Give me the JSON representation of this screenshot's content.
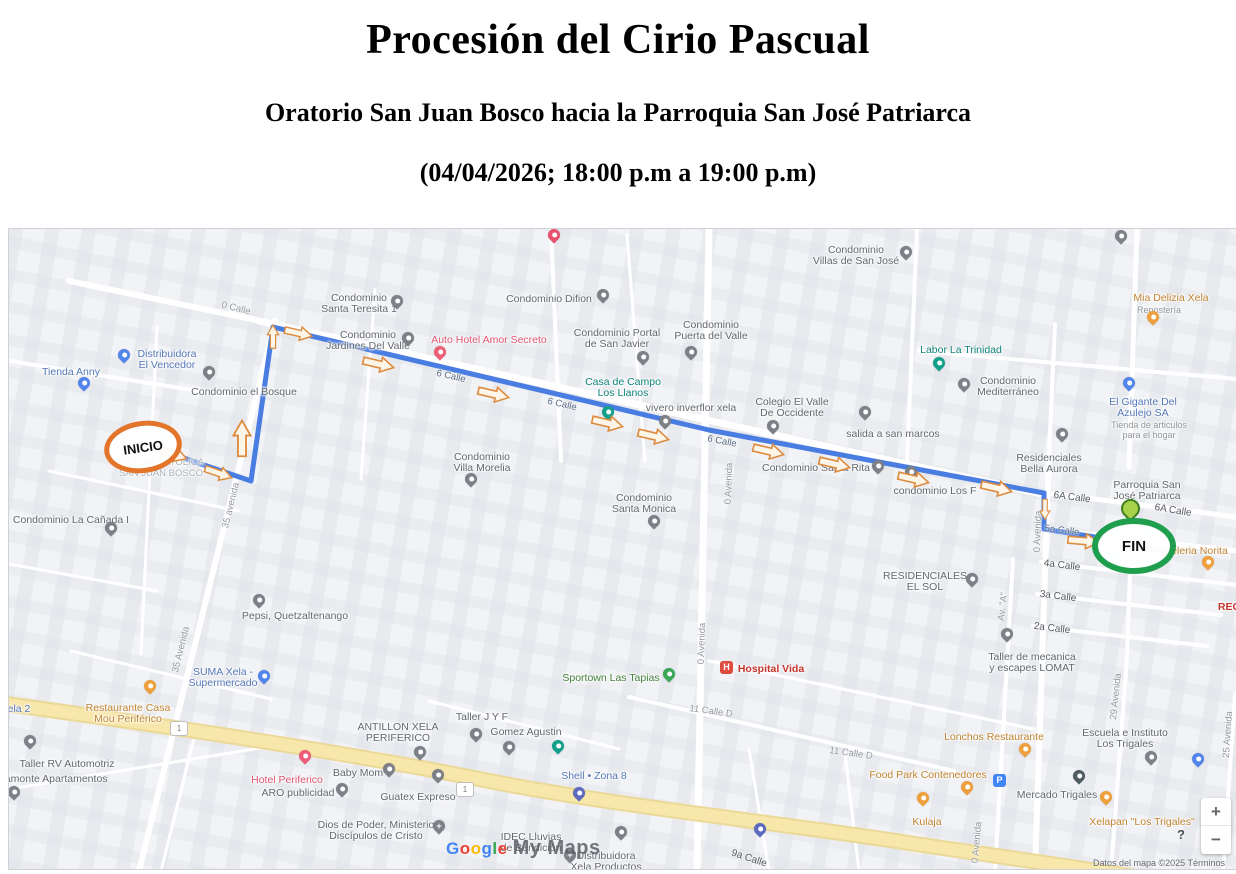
{
  "header": {
    "title": "Procesión del Cirio Pascual",
    "subtitle": "Oratorio San Juan Bosco hacia la Parroquia San José Patriarca",
    "schedule": "(04/04/2026; 18:00 p.m a 19:00 p.m)"
  },
  "map": {
    "attribution": "Datos del mapa ©2025      Términos",
    "watermark": {
      "brand": "Google",
      "product": "My Maps",
      "brand_colors": [
        "#4285F4",
        "#EA4335",
        "#FBBC05",
        "#4285F4",
        "#34A853",
        "#EA4335"
      ]
    },
    "controls": {
      "zoom_in": "+",
      "zoom_out": "−",
      "help": "?"
    },
    "route": {
      "start_label": "INICIO",
      "end_label": "FIN",
      "color": "#4a7de2",
      "start_ring_color": "#e2752a",
      "end_ring_color": "#1f9e4d",
      "points": [
        [
          157,
          223
        ],
        [
          242,
          252
        ],
        [
          264,
          98
        ],
        [
          700,
          201
        ],
        [
          1035,
          264
        ],
        [
          1035,
          300
        ],
        [
          1092,
          309
        ]
      ],
      "arrows": [
        {
          "x": 164,
          "y": 225,
          "r": 19,
          "s": 0.9
        },
        {
          "x": 209,
          "y": 244,
          "r": 19,
          "s": 0.9
        },
        {
          "x": 233,
          "y": 210,
          "r": -90,
          "s": 1.15
        },
        {
          "x": 264,
          "y": 108,
          "r": -90,
          "s": 0.75
        },
        {
          "x": 289,
          "y": 104,
          "r": 13,
          "s": 0.9
        },
        {
          "x": 369,
          "y": 135,
          "r": 13,
          "s": 1
        },
        {
          "x": 484,
          "y": 165,
          "r": 13,
          "s": 1
        },
        {
          "x": 598,
          "y": 194,
          "r": 13,
          "s": 1
        },
        {
          "x": 644,
          "y": 207,
          "r": 13,
          "s": 1
        },
        {
          "x": 759,
          "y": 222,
          "r": 13,
          "s": 1
        },
        {
          "x": 825,
          "y": 235,
          "r": 13,
          "s": 1
        },
        {
          "x": 904,
          "y": 250,
          "r": 13,
          "s": 1
        },
        {
          "x": 987,
          "y": 259,
          "r": 13,
          "s": 1
        },
        {
          "x": 1036,
          "y": 280,
          "r": 90,
          "s": 0.65
        },
        {
          "x": 1074,
          "y": 312,
          "r": 5,
          "s": 1
        }
      ]
    },
    "shields": {
      "label": "1",
      "positions": [
        {
          "x": 169,
          "y": 499
        },
        {
          "x": 455,
          "y": 560
        }
      ]
    },
    "street_labels": [
      {
        "text": "0 Calle",
        "x": 227,
        "y": 74,
        "rot": 14
      },
      {
        "text": "35 avenida",
        "x": 222,
        "y": 271,
        "rot": -76
      },
      {
        "text": "6 Calle",
        "x": 442,
        "y": 142,
        "rot": 13,
        "cls": "route"
      },
      {
        "text": "6 Calle",
        "x": 553,
        "y": 170,
        "rot": 13,
        "cls": "route"
      },
      {
        "text": "6 Calle",
        "x": 713,
        "y": 207,
        "rot": 11,
        "cls": "route"
      },
      {
        "text": "0 Avenida",
        "x": 720,
        "y": 249,
        "rot": -88
      },
      {
        "text": "0 Avenida",
        "x": 693,
        "y": 409,
        "rot": -88
      },
      {
        "text": "6A Calle",
        "x": 1063,
        "y": 263,
        "rot": 7,
        "cls": "dark"
      },
      {
        "text": "6A Calle",
        "x": 1164,
        "y": 276,
        "rot": 9,
        "cls": "dark"
      },
      {
        "text": "5a Calle",
        "x": 1053,
        "y": 296,
        "rot": 7,
        "cls": "route"
      },
      {
        "text": "4a Calle",
        "x": 1053,
        "y": 331,
        "rot": 7,
        "cls": "dark"
      },
      {
        "text": "3a Calle",
        "x": 1049,
        "y": 362,
        "rot": 7,
        "cls": "dark"
      },
      {
        "text": "2a Calle",
        "x": 1043,
        "y": 394,
        "rot": 7,
        "cls": "dark"
      },
      {
        "text": "0 Avenida",
        "x": 1029,
        "y": 297,
        "rot": -88
      },
      {
        "text": "0 Avenida",
        "x": 968,
        "y": 608,
        "rot": -85
      },
      {
        "text": "Av. \"A\"",
        "x": 994,
        "y": 372,
        "rot": -83
      },
      {
        "text": "29 Avenida",
        "x": 1107,
        "y": 462,
        "rot": -84
      },
      {
        "text": "25 Avenida",
        "x": 1219,
        "y": 500,
        "rot": -86
      },
      {
        "text": "11 Calle D",
        "x": 702,
        "y": 477,
        "rot": 8
      },
      {
        "text": "11 Calle D",
        "x": 842,
        "y": 519,
        "rot": 8
      },
      {
        "text": "35 Avenida",
        "x": 172,
        "y": 415,
        "rot": -76
      },
      {
        "text": "9a Calle",
        "x": 740,
        "y": 624,
        "rot": 18,
        "cls": "dark"
      }
    ],
    "pois": [
      {
        "lines": [
          "Tienda Anny"
        ],
        "cls": "blue",
        "lx": 62,
        "ly": 138,
        "pin": {
          "x": 75,
          "y": 162,
          "c": "#5185ec"
        }
      },
      {
        "lines": [
          "Distribuidora",
          "El Vencedor"
        ],
        "cls": "blue",
        "lx": 158,
        "ly": 120,
        "pin": {
          "x": 115,
          "y": 134,
          "c": "#5185ec"
        }
      },
      {
        "lines": [
          "SUMA Xela -",
          "Supermercado"
        ],
        "cls": "blue",
        "lx": 214,
        "ly": 438,
        "pin": {
          "x": 255,
          "y": 455,
          "c": "#5185ec"
        }
      },
      {
        "lines": [
          "Shell • Zona 8"
        ],
        "cls": "blue",
        "lx": 585,
        "ly": 542,
        "pin": {
          "x": 570,
          "y": 572,
          "c": "#5c6bc0"
        }
      },
      {
        "lines": [
          "El Gigante Del",
          "Azulejo SA"
        ],
        "cls": "blue",
        "lx": 1134,
        "ly": 168,
        "pin": {
          "x": 1120,
          "y": 162,
          "c": "#5185ec"
        }
      },
      {
        "lines": [
          "Tienda de articulos",
          "para el hogar"
        ],
        "cls": "graysmall",
        "lx": 1140,
        "ly": 191
      },
      {
        "lines": [
          "Condominio el Bosque"
        ],
        "cls": "gray",
        "lx": 235,
        "ly": 158,
        "pin": {
          "x": 200,
          "y": 151,
          "c": "#7d8187"
        }
      },
      {
        "lines": [
          "Condominio La Cañada I"
        ],
        "cls": "gray",
        "lx": 62,
        "ly": 286,
        "pin": {
          "x": 102,
          "y": 307,
          "c": "#7d8187"
        }
      },
      {
        "lines": [
          "Condominio",
          "Santa Teresita 1"
        ],
        "cls": "gray",
        "lx": 350,
        "ly": 64,
        "pin": {
          "x": 388,
          "y": 80,
          "c": "#7d8187"
        }
      },
      {
        "lines": [
          "Condominio",
          "Jardines Del Valle"
        ],
        "cls": "gray",
        "lx": 359,
        "ly": 101,
        "pin": {
          "x": 399,
          "y": 117,
          "c": "#7d8187"
        }
      },
      {
        "lines": [
          "Auto Hotel Amor Secreto"
        ],
        "cls": "pink",
        "lx": 480,
        "ly": 106,
        "pin": {
          "x": 431,
          "y": 131,
          "c": "#ee5d78"
        }
      },
      {
        "lines": [
          "Condominio Difion"
        ],
        "cls": "gray",
        "lx": 540,
        "ly": 65,
        "pin": {
          "x": 594,
          "y": 74,
          "c": "#7d8187"
        }
      },
      {
        "lines": [
          "Condominio Portal",
          "de San Javier"
        ],
        "cls": "gray",
        "lx": 608,
        "ly": 99,
        "pin": {
          "x": 634,
          "y": 136,
          "c": "#7d8187"
        }
      },
      {
        "lines": [
          "Condominio",
          "Puerta del Valle"
        ],
        "cls": "gray",
        "lx": 702,
        "ly": 91,
        "pin": {
          "x": 682,
          "y": 131,
          "c": "#7d8187"
        }
      },
      {
        "lines": [
          "Condominio",
          "Villas de San José"
        ],
        "cls": "gray",
        "lx": 847,
        "ly": 16,
        "pin": {
          "x": 897,
          "y": 31,
          "c": "#7d8187"
        }
      },
      {
        "lines": [
          "Casa de Campo",
          "Los Llanos"
        ],
        "cls": "teal",
        "lx": 614,
        "ly": 148,
        "pin": {
          "x": 599,
          "y": 191,
          "c": "#13a08b"
        }
      },
      {
        "lines": [
          "vivero inverflor xela"
        ],
        "cls": "gray",
        "lx": 682,
        "ly": 174,
        "pin": {
          "x": 656,
          "y": 200,
          "c": "#7d8187"
        }
      },
      {
        "lines": [
          "Colegio El Valle",
          "De Occidente"
        ],
        "cls": "gray",
        "lx": 783,
        "ly": 168,
        "pin": {
          "x": 764,
          "y": 205,
          "c": "#7d8187"
        }
      },
      {
        "lines": [
          "salida a san marcos"
        ],
        "cls": "gray",
        "lx": 884,
        "ly": 200,
        "pin": {
          "x": 856,
          "y": 191,
          "c": "#7d8187"
        }
      },
      {
        "lines": [
          "Condominio",
          "Mediterráneo"
        ],
        "cls": "gray",
        "lx": 999,
        "ly": 147,
        "pin": {
          "x": 955,
          "y": 163,
          "c": "#7d8187"
        }
      },
      {
        "lines": [
          "Labor La Trinidad"
        ],
        "cls": "teal",
        "lx": 952,
        "ly": 116,
        "pin": {
          "x": 930,
          "y": 142,
          "c": "#13a08b"
        }
      },
      {
        "lines": [
          "Condominio",
          "Santa Monica"
        ],
        "cls": "gray",
        "lx": 635,
        "ly": 264,
        "pin": {
          "x": 645,
          "y": 300,
          "c": "#7d8187"
        }
      },
      {
        "lines": [
          "Condominio",
          "Villa Morelia"
        ],
        "cls": "gray",
        "lx": 473,
        "ly": 223,
        "pin": {
          "x": 462,
          "y": 258,
          "c": "#7d8187"
        }
      },
      {
        "lines": [
          "Condominio Santa Rita"
        ],
        "cls": "gray",
        "lx": 807,
        "ly": 234,
        "pin": {
          "x": 869,
          "y": 245,
          "c": "#7d8187"
        }
      },
      {
        "lines": [
          "condominio Los F"
        ],
        "cls": "gray",
        "lx": 926,
        "ly": 257,
        "pin": {
          "x": 902,
          "y": 251,
          "c": "#7d8187"
        }
      },
      {
        "lines": [
          "Residenciales",
          "Bella Aurora"
        ],
        "cls": "gray",
        "lx": 1040,
        "ly": 224,
        "pin": {
          "x": 1053,
          "y": 213,
          "c": "#7d8187"
        }
      },
      {
        "lines": [
          "Parroquia San",
          "José Patriarca"
        ],
        "cls": "gray",
        "lx": 1138,
        "ly": 251,
        "pin": {
          "x": 1121,
          "y": 292,
          "c": "#a8d24a",
          "t": "lime"
        }
      },
      {
        "lines": [
          "Pasteleria Norita"
        ],
        "cls": "orange",
        "lx": 1180,
        "ly": 317,
        "pin": {
          "x": 1199,
          "y": 341,
          "c": "#efa03c"
        }
      },
      {
        "lines": [
          "RESIDENCIALES",
          "EL SOL"
        ],
        "cls": "gray",
        "lx": 916,
        "ly": 342,
        "pin": {
          "x": 963,
          "y": 358,
          "c": "#7d8187"
        }
      },
      {
        "lines": [
          "Taller de mecanica",
          "y escapes LOMAT"
        ],
        "cls": "gray",
        "lx": 1023,
        "ly": 423,
        "pin": {
          "x": 998,
          "y": 413,
          "c": "#7d8187"
        }
      },
      {
        "lines": [
          "Pepsi, Quetzaltenango"
        ],
        "cls": "gray",
        "lx": 286,
        "ly": 382,
        "pin": {
          "x": 250,
          "y": 379,
          "c": "#7d8187"
        }
      },
      {
        "lines": [
          "Mia Delizia Xela"
        ],
        "cls": "orange",
        "lx": 1162,
        "ly": 64,
        "pin": {
          "x": 1144,
          "y": 96,
          "c": "#efa03c"
        }
      },
      {
        "lines": [
          "Repostería"
        ],
        "cls": "graysmall",
        "lx": 1150,
        "ly": 76
      },
      {
        "cls": "gray",
        "lines": [],
        "pin": {
          "x": 1112,
          "y": 15,
          "c": "#7d8187"
        }
      },
      {
        "lines": [
          "Restaurante Casa",
          "Mou Periférico"
        ],
        "cls": "orange",
        "lx": 119,
        "ly": 474,
        "pin": {
          "x": 141,
          "y": 465,
          "c": "#efa03c"
        }
      },
      {
        "lines": [
          "Taller RV Automotriz"
        ],
        "cls": "gray",
        "lx": 58,
        "ly": 530,
        "pin": {
          "x": 21,
          "y": 520,
          "c": "#7d8187"
        }
      },
      {
        "lines": [
          "iamonte Apartamentos"
        ],
        "cls": "gray",
        "lx": 46,
        "ly": 545,
        "pin": {
          "x": 5,
          "y": 571,
          "c": "#7d8187"
        }
      },
      {
        "lines": [
          "ela 2"
        ],
        "cls": "blue",
        "lx": 10,
        "ly": 475
      },
      {
        "lines": [
          "Hotel Periferico"
        ],
        "cls": "pink",
        "lx": 278,
        "ly": 546,
        "pin": {
          "x": 296,
          "y": 535,
          "c": "#ee5d78"
        }
      },
      {
        "lines": [
          "Baby Mom"
        ],
        "cls": "gray",
        "lx": 349,
        "ly": 539,
        "pin": {
          "x": 380,
          "y": 548,
          "c": "#7d8187"
        }
      },
      {
        "lines": [
          "ARO publicidad"
        ],
        "cls": "gray",
        "lx": 289,
        "ly": 559,
        "pin": {
          "x": 333,
          "y": 568,
          "c": "#7d8187"
        }
      },
      {
        "lines": [
          "Dios de Poder, Ministerio",
          "Discípulos de Cristo"
        ],
        "cls": "gray",
        "lx": 367,
        "ly": 591,
        "pin": {
          "x": 430,
          "y": 605,
          "c": "#7d8187",
          "t": "cross"
        }
      },
      {
        "lines": [
          "ANTILLON XELA",
          "PERIFERICO"
        ],
        "cls": "gray",
        "lx": 389,
        "ly": 493,
        "pin": {
          "x": 411,
          "y": 531,
          "c": "#7d8187"
        }
      },
      {
        "lines": [
          "Taller J Y F"
        ],
        "cls": "gray",
        "lx": 473,
        "ly": 483,
        "pin": {
          "x": 467,
          "y": 513,
          "c": "#7d8187"
        }
      },
      {
        "lines": [
          "Gomez Agustin"
        ],
        "cls": "gray",
        "lx": 517,
        "ly": 498,
        "pin": {
          "x": 500,
          "y": 526,
          "c": "#7d8187"
        }
      },
      {
        "cls": "teal",
        "lines": [],
        "pin": {
          "x": 549,
          "y": 525,
          "c": "#13a08b"
        }
      },
      {
        "lines": [
          "Guatex Expreso"
        ],
        "cls": "gray",
        "lx": 409,
        "ly": 563,
        "pin": {
          "x": 429,
          "y": 554,
          "c": "#7d8187"
        }
      },
      {
        "lines": [
          "IDEC Lluvias",
          "de Bendición"
        ],
        "cls": "gray",
        "lx": 522,
        "ly": 603,
        "pin": {
          "x": 561,
          "y": 634,
          "c": "#7d8187",
          "t": "cross"
        }
      },
      {
        "lines": [
          "Distribuidora",
          "Xela Productos"
        ],
        "cls": "gray",
        "lx": 597,
        "ly": 622,
        "pin": {
          "x": 612,
          "y": 611,
          "c": "#7d8187"
        }
      },
      {
        "lines": [
          "Sportown Las Tapias"
        ],
        "cls": "green",
        "lx": 602,
        "ly": 444,
        "pin": {
          "x": 660,
          "y": 453,
          "c": "#3aa757"
        }
      },
      {
        "lines": [
          "Hospital Vida"
        ],
        "cls": "red",
        "lx": 762,
        "ly": 435,
        "pin": {
          "x": 717,
          "y": 439,
          "c": "#dd4b3e",
          "t": "H"
        }
      },
      {
        "lines": [
          "Lonchos Restaurante"
        ],
        "cls": "orange",
        "lx": 985,
        "ly": 503,
        "pin": {
          "x": 1016,
          "y": 528,
          "c": "#efa03c"
        }
      },
      {
        "lines": [
          "Food Park Contenedores"
        ],
        "cls": "orange",
        "lx": 919,
        "ly": 541,
        "pin": {
          "x": 958,
          "y": 566,
          "c": "#efa03c"
        }
      },
      {
        "lines": [
          "Kulaja"
        ],
        "cls": "orange",
        "lx": 918,
        "ly": 588,
        "pin": {
          "x": 914,
          "y": 577,
          "c": "#efa03c"
        }
      },
      {
        "lines": [
          "Mercado Trigales"
        ],
        "cls": "gray",
        "lx": 1048,
        "ly": 561,
        "pin": {
          "x": 1070,
          "y": 555,
          "c": "#4f5b63"
        }
      },
      {
        "lines": [
          "Escuela e Instituto",
          "Los Trigales"
        ],
        "cls": "gray",
        "lx": 1116,
        "ly": 499,
        "pin": {
          "x": 1142,
          "y": 536,
          "c": "#7d8187"
        }
      },
      {
        "lines": [
          "Xelapan \"Los Trigales\""
        ],
        "cls": "orange",
        "lx": 1133,
        "ly": 588,
        "pin": {
          "x": 1097,
          "y": 576,
          "c": "#efa03c"
        }
      },
      {
        "lines": [
          "REC"
        ],
        "cls": "red",
        "lx": 1220,
        "ly": 373
      },
      {
        "cls": "blue",
        "lines": [],
        "pin": {
          "x": 990,
          "y": 552,
          "c": "#4285f4",
          "t": "P"
        }
      },
      {
        "cls": "blue",
        "lines": [],
        "pin": {
          "x": 1189,
          "y": 538,
          "c": "#5185ec"
        }
      },
      {
        "cls": "blue",
        "lines": [],
        "pin": {
          "x": 751,
          "y": 608,
          "c": "#5c6bc0"
        }
      },
      {
        "cls": "pink",
        "lines": [],
        "pin": {
          "x": 545,
          "y": 14,
          "c": "#e8506e"
        }
      },
      {
        "lines": [
          "IGLESIA CATOLICA",
          "SAN JUAN BOSCO"
        ],
        "cls": "faded",
        "lx": 152,
        "ly": 228
      }
    ]
  }
}
